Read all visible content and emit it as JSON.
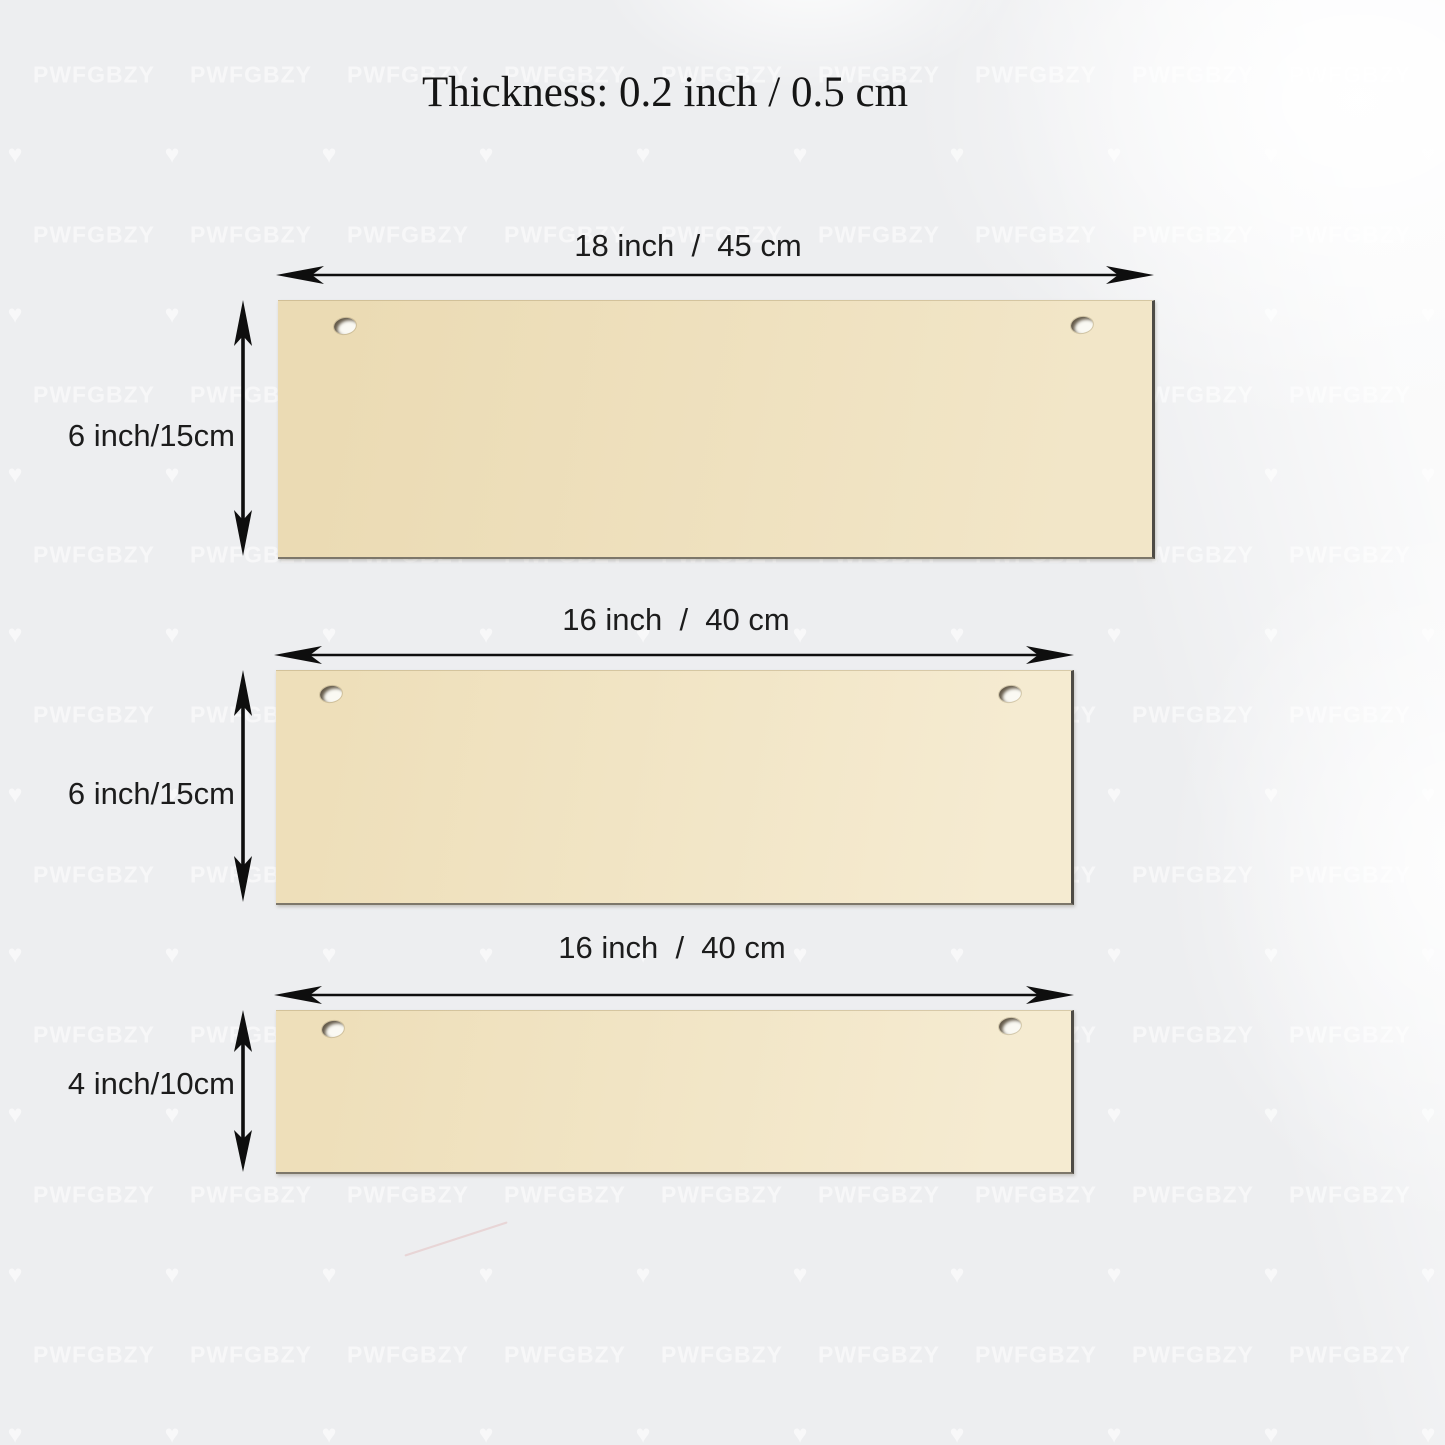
{
  "title": "Thickness: 0.2 inch / 0.5 cm",
  "watermark": {
    "text": "PWFGBZY",
    "heart_icon": "♥"
  },
  "boards": [
    {
      "name": "board-18x6",
      "width_label": "18 inch  /  45 cm",
      "height_label": "6 inch/15cm"
    },
    {
      "name": "board-16x6",
      "width_label": "16 inch  /  40 cm",
      "height_label": "6 inch/15cm"
    },
    {
      "name": "board-16x4",
      "width_label": "16 inch  /  40 cm",
      "height_label": "4 inch/10cm"
    }
  ],
  "colors": {
    "background": "#edeef0",
    "board_face": "#eedfba",
    "board_face_light": "#f5ebd1",
    "board_edge": "#4e4b45",
    "arrow": "#0e0e0e"
  }
}
